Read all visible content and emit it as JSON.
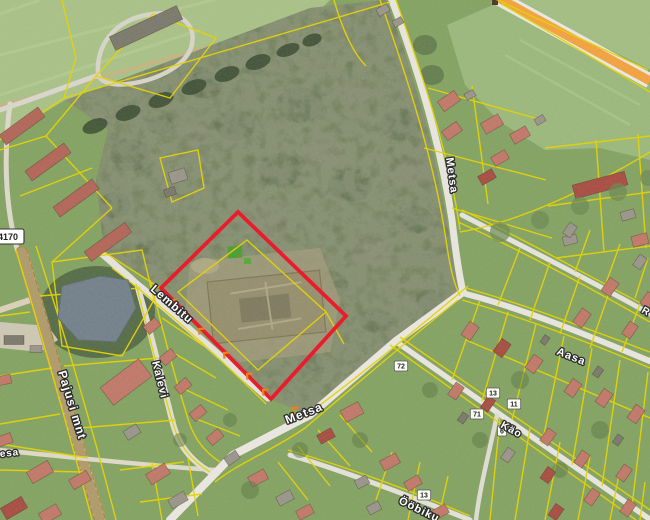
{
  "map": {
    "streets": [
      {
        "name": "lembitu",
        "label": "Lembitu",
        "x": 150,
        "y": 290,
        "rotate": 41,
        "size": 11.5
      },
      {
        "name": "kalevi",
        "label": "Kalevi",
        "x": 152,
        "y": 362,
        "rotate": 76,
        "size": 11
      },
      {
        "name": "pajusi-mnt",
        "label": "Pajusi mnt",
        "x": 58,
        "y": 372,
        "rotate": 73,
        "size": 12
      },
      {
        "name": "metsa-north",
        "label": "Metsa",
        "x": 446,
        "y": 158,
        "rotate": 82,
        "size": 11
      },
      {
        "name": "metsa-south",
        "label": "Metsa",
        "x": 287,
        "y": 424,
        "rotate": -21,
        "size": 12
      },
      {
        "name": "aasa",
        "label": "Aasa",
        "x": 556,
        "y": 354,
        "rotate": 22,
        "size": 11
      },
      {
        "name": "kao",
        "label": "Käo",
        "x": 500,
        "y": 427,
        "rotate": 29,
        "size": 10.5
      },
      {
        "name": "oobiku",
        "label": "Ööbiku",
        "x": 398,
        "y": 503,
        "rotate": 26,
        "size": 11
      },
      {
        "name": "r-street-fragment",
        "label": "R",
        "x": 641,
        "y": 312,
        "rotate": 30,
        "size": 10
      },
      {
        "name": "kesa-fragment",
        "label": "Kesa",
        "x": -8,
        "y": 458,
        "rotate": -6,
        "size": 10
      }
    ],
    "road_badge": {
      "label": "4170",
      "x": -8,
      "y": 229,
      "w": 32,
      "h": 15
    },
    "house_numbers": [
      {
        "label": "72",
        "x": 401,
        "y": 366
      },
      {
        "label": "13",
        "x": 493,
        "y": 393
      },
      {
        "label": "11",
        "x": 514,
        "y": 404
      },
      {
        "label": "71",
        "x": 477,
        "y": 414
      },
      {
        "label": "6",
        "x": 502,
        "y": 431
      },
      {
        "label": "13",
        "x": 424,
        "y": 495
      }
    ],
    "selection": {
      "points": "238,212 346,316 271,399 161,288",
      "color": "#ea1c2c"
    },
    "chevrons": {
      "points": [
        [
          172,
          300
        ],
        [
          199,
          329
        ],
        [
          224,
          353
        ],
        [
          247,
          374
        ],
        [
          263,
          390
        ],
        [
          293,
          408
        ]
      ],
      "rotate": 40,
      "color": "#e8821e"
    },
    "palette": {
      "cadastral_line": "#e3d206",
      "selection_red": "#ea1c2c",
      "highway_orange": "#f0a343",
      "road_light": "#e7e5dd",
      "road_main": "#ecd9a2",
      "water": "#75828c",
      "label_fill": "#ffffff",
      "label_halo": "#2b2b2b"
    },
    "house_colors": [
      "#c07a6b",
      "#a85046",
      "#9a968c",
      "#7d7a6e",
      "#b2685a",
      "#c9b694"
    ],
    "houses": [
      [
        22,
        126,
        48,
        12,
        -36,
        4
      ],
      [
        48,
        162,
        48,
        12,
        -36,
        4
      ],
      [
        76,
        198,
        48,
        12,
        -36,
        4
      ],
      [
        108,
        242,
        50,
        12,
        -36,
        4
      ],
      [
        146,
        28,
        74,
        15,
        -25,
        3
      ],
      [
        383,
        10,
        12,
        8,
        -30,
        2
      ],
      [
        398,
        22,
        10,
        7,
        -30,
        2
      ],
      [
        178,
        176,
        17,
        12,
        -18,
        2
      ],
      [
        170,
        192,
        11,
        8,
        -20,
        3
      ],
      [
        126,
        382,
        48,
        22,
        -37,
        0
      ],
      [
        14,
        340,
        20,
        9,
        0,
        3
      ],
      [
        36,
        349,
        12,
        7,
        0,
        2
      ],
      [
        40,
        472,
        24,
        13,
        -30,
        0
      ],
      [
        14,
        508,
        24,
        13,
        -30,
        1
      ],
      [
        50,
        514,
        20,
        12,
        -30,
        0
      ],
      [
        80,
        480,
        20,
        11,
        -30,
        0
      ],
      [
        4,
        440,
        16,
        10,
        -20,
        0
      ],
      [
        4,
        380,
        14,
        9,
        -12,
        0
      ],
      [
        158,
        474,
        22,
        12,
        -32,
        0
      ],
      [
        132,
        432,
        15,
        10,
        -32,
        2
      ],
      [
        178,
        500,
        18,
        10,
        -30,
        2
      ],
      [
        152,
        326,
        15,
        10,
        -40,
        0
      ],
      [
        168,
        357,
        15,
        10,
        -40,
        0
      ],
      [
        183,
        386,
        15,
        10,
        -40,
        0
      ],
      [
        198,
        413,
        15,
        10,
        -40,
        0
      ],
      [
        215,
        437,
        15,
        10,
        -40,
        0
      ],
      [
        232,
        458,
        14,
        9,
        -35,
        2
      ],
      [
        258,
        478,
        18,
        11,
        -28,
        0
      ],
      [
        285,
        498,
        16,
        10,
        -28,
        2
      ],
      [
        305,
        512,
        16,
        10,
        -28,
        0
      ],
      [
        352,
        412,
        20,
        13,
        -28,
        0
      ],
      [
        326,
        436,
        16,
        10,
        -28,
        1
      ],
      [
        390,
        462,
        18,
        11,
        -28,
        0
      ],
      [
        362,
        482,
        13,
        9,
        -28,
        2
      ],
      [
        413,
        483,
        16,
        10,
        -30,
        0
      ],
      [
        440,
        512,
        16,
        10,
        -30,
        0
      ],
      [
        374,
        508,
        13,
        9,
        -28,
        2
      ],
      [
        449,
        101,
        20,
        12,
        -35,
        0
      ],
      [
        452,
        131,
        18,
        11,
        -35,
        0
      ],
      [
        492,
        124,
        20,
        12,
        -30,
        0
      ],
      [
        520,
        135,
        18,
        11,
        -30,
        0
      ],
      [
        500,
        158,
        16,
        10,
        -30,
        0
      ],
      [
        487,
        177,
        16,
        10,
        -30,
        1
      ],
      [
        470,
        95,
        10,
        7,
        -30,
        2
      ],
      [
        540,
        120,
        10,
        7,
        -30,
        2
      ],
      [
        600,
        185,
        54,
        14,
        -15,
        1
      ],
      [
        628,
        215,
        14,
        9,
        -15,
        2
      ],
      [
        570,
        240,
        14,
        9,
        -15,
        2
      ],
      [
        640,
        240,
        16,
        11,
        -15,
        0
      ],
      [
        610,
        287,
        16,
        11,
        -55,
        0
      ],
      [
        582,
        318,
        17,
        11,
        -55,
        0
      ],
      [
        630,
        330,
        15,
        10,
        -55,
        0
      ],
      [
        648,
        300,
        14,
        10,
        -55,
        0
      ],
      [
        640,
        262,
        13,
        9,
        -55,
        2
      ],
      [
        470,
        331,
        16,
        11,
        -55,
        0
      ],
      [
        502,
        348,
        16,
        11,
        -55,
        1
      ],
      [
        534,
        364,
        16,
        11,
        -55,
        0
      ],
      [
        573,
        388,
        16,
        11,
        -55,
        0
      ],
      [
        604,
        398,
        16,
        11,
        -55,
        0
      ],
      [
        636,
        414,
        16,
        11,
        -55,
        0
      ],
      [
        456,
        391,
        15,
        10,
        -55,
        0
      ],
      [
        488,
        404,
        14,
        9,
        -55,
        1
      ],
      [
        548,
        437,
        15,
        10,
        -55,
        0
      ],
      [
        582,
        459,
        15,
        10,
        -55,
        0
      ],
      [
        624,
        473,
        15,
        10,
        -55,
        0
      ],
      [
        548,
        475,
        14,
        10,
        -55,
        1
      ],
      [
        592,
        497,
        15,
        10,
        -55,
        0
      ],
      [
        628,
        508,
        15,
        10,
        -55,
        0
      ],
      [
        556,
        512,
        14,
        10,
        -55,
        1
      ],
      [
        508,
        455,
        13,
        9,
        -55,
        2
      ],
      [
        598,
        372,
        10,
        7,
        -55,
        3
      ],
      [
        545,
        340,
        9,
        6,
        -55,
        3
      ],
      [
        618,
        440,
        10,
        7,
        -55,
        3
      ],
      [
        463,
        418,
        10,
        7,
        -55,
        3
      ],
      [
        570,
        230,
        13,
        9,
        -55,
        2
      ]
    ]
  }
}
